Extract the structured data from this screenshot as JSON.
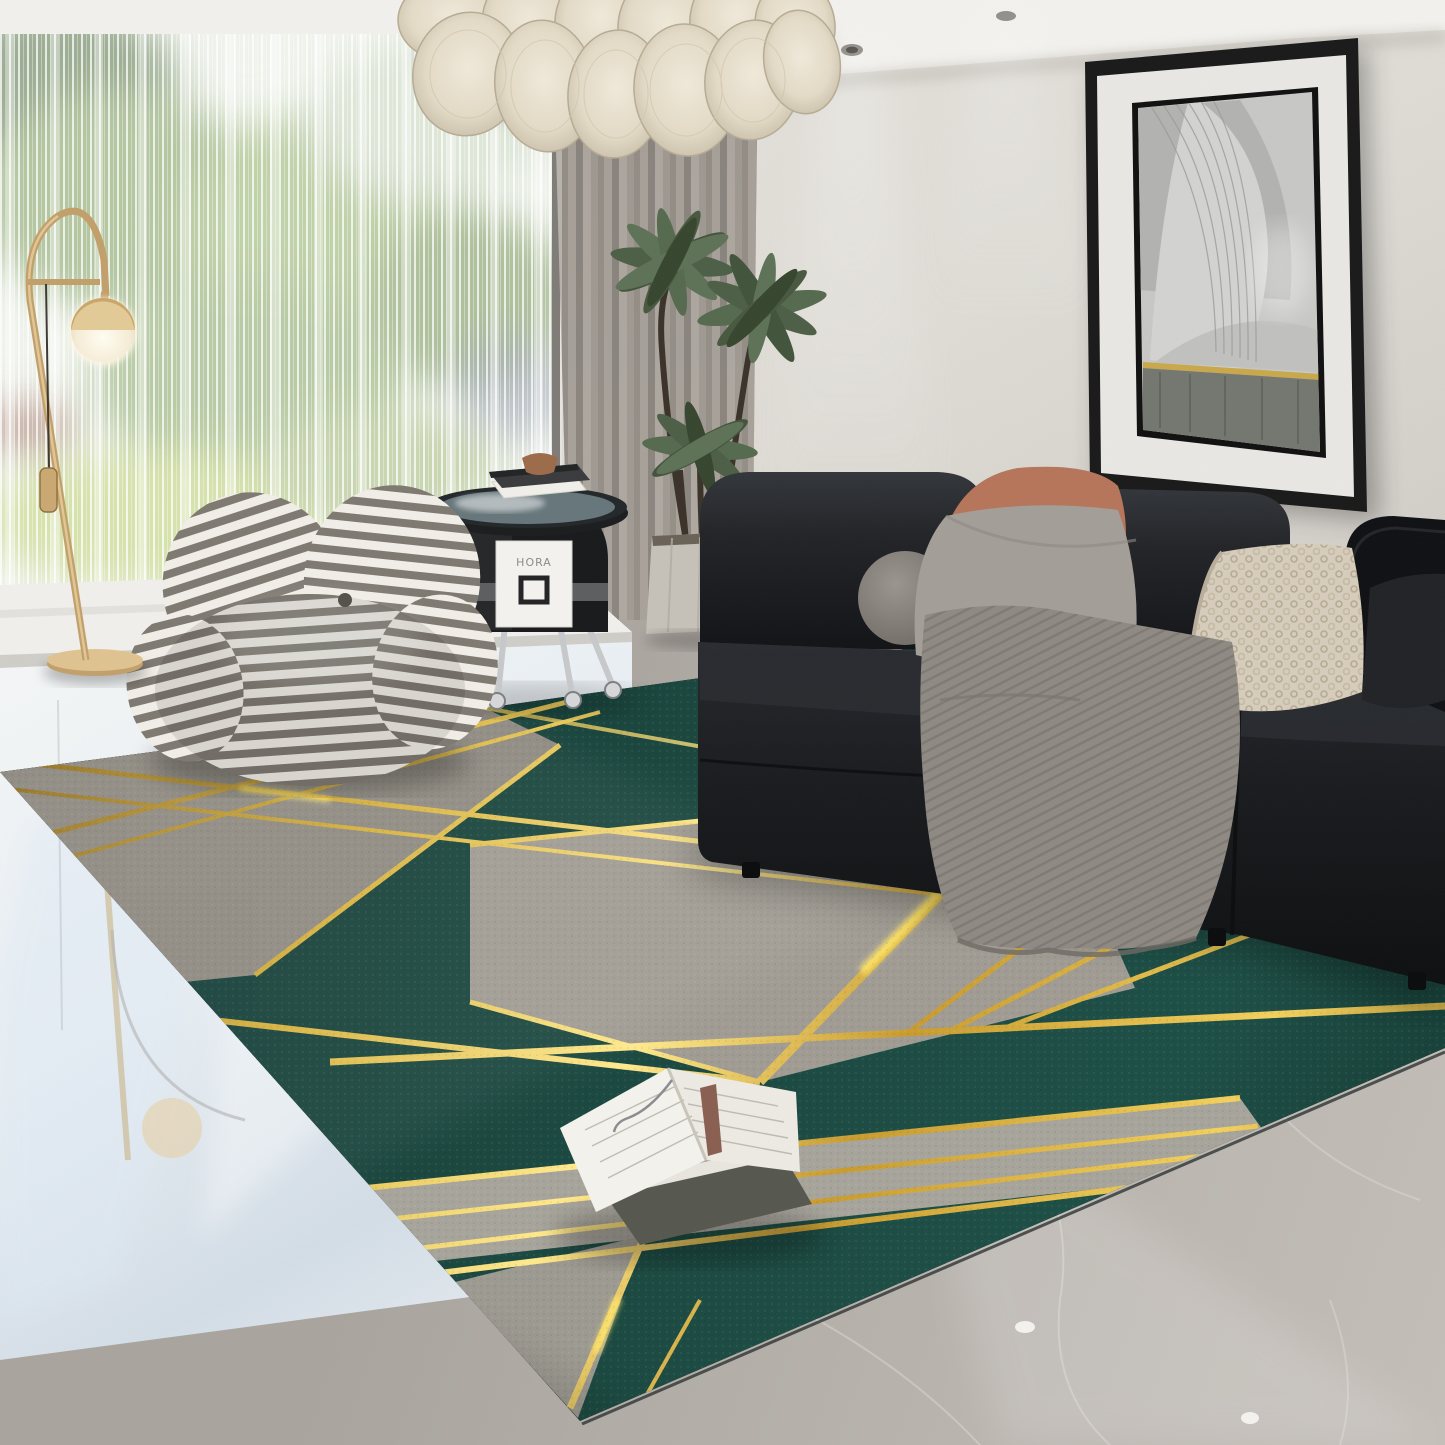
{
  "scene": {
    "description": "living-room product photo of a geometric area rug",
    "room": "modern living room with floor-to-ceiling window",
    "side_table_panel_text": "HORA"
  },
  "palette": {
    "wall": "#dedbd5",
    "ceiling": "#f3f1ed",
    "curtain_grey": "#968f88",
    "sheer_white": "#eef2ea",
    "foliage_green": "#8aa76c",
    "rug_teal": "#1a473f",
    "rug_teal_dark": "#0f332d",
    "rug_grey": "#9c988e",
    "rug_gold": "#e3bc45",
    "rug_border_black": "#0b0d0e",
    "sofa_leather_black": "#17181b",
    "pillow_grey": "#a49e98",
    "pillow_terracotta": "#b5755a",
    "pillow_knit_cream": "#d6ccbc",
    "throw_grey": "#8f8983",
    "marble_floor": "#b5b0aa",
    "glossy_floor": "#e9eef2",
    "brass_gold": "#c2a06a",
    "chandelier_cream": "#e7dfcd",
    "chair_stripe_grey": "#7e7971",
    "chair_stripe_cream": "#f1eee7",
    "art_frame": "#1a1a1a",
    "art_mat": "#e9e7e3"
  },
  "objects": {
    "chandelier": "woven-disc pendant chandelier",
    "floor_lamp": "brass arc floor lamp with globe shade",
    "armchair": "striped rounded lounge chair",
    "side_table": "black arch side table with glass top",
    "plant": "potted palm plant",
    "sofa": "black leather modular sofa",
    "wall_art": "framed black-and-white architecture print",
    "rug": "emerald green rug with grey blocks and gold lines",
    "books": "open book on closed book",
    "floors": "glossy porcelain by window, grey marble elsewhere"
  }
}
